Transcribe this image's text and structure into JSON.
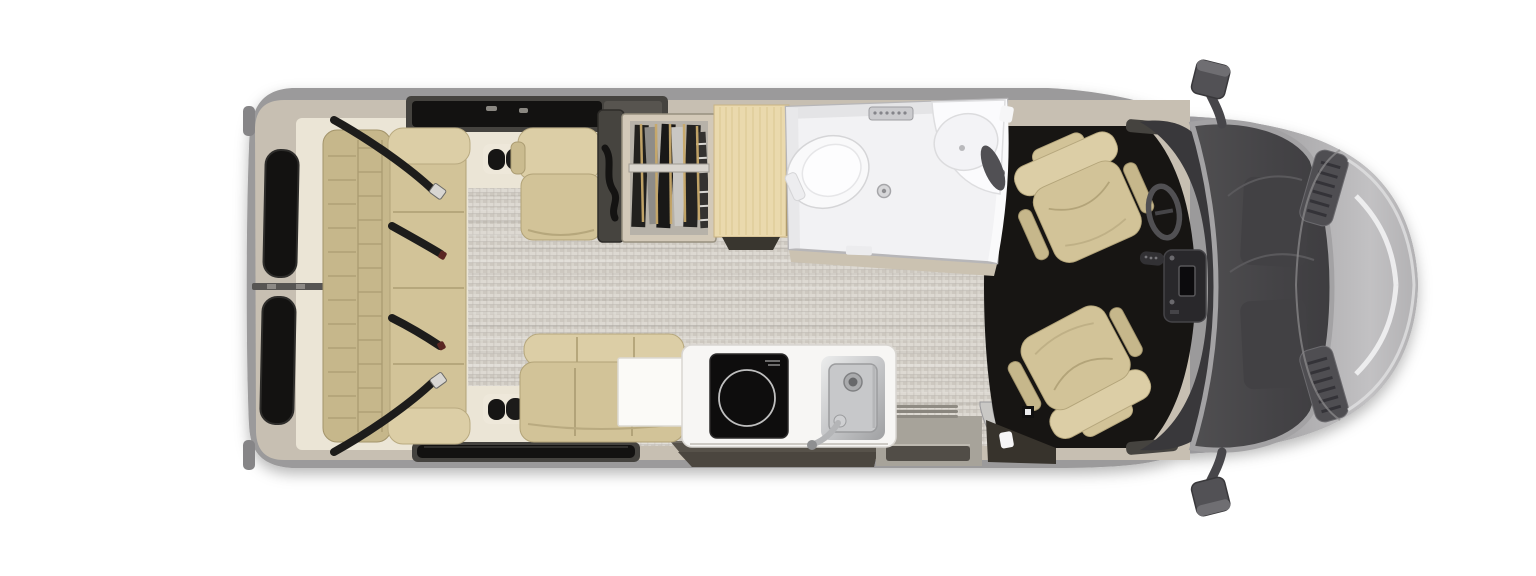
{
  "meta": {
    "title": "Class B touring coach floor plan — overhead view",
    "description": "Top-down rendering of a camper van interior: rear sofa with four seat belts, single lounge seat, wardrobe with hanging clothes, wood countertop, wet bath with toilet and corner sink, dinette bench with table, galley with induction cooktop and stainless sink, sliding-door step well, two swiveled cab chairs, dashboard with steering wheel, windshield, hood and side mirrors."
  },
  "colors": {
    "page-bg": "#ffffff",
    "body": "#9b9a9b",
    "lining": "#c7bfb2",
    "cream": "#ebe5d6",
    "floor": "#d6d2ca",
    "tan": "#d2c398",
    "tan-dark": "#b2a378",
    "tan-light": "#dccea6",
    "tan-back": "#c6b78b",
    "belt": "#1d1c1b",
    "cab": "#171513",
    "dash": "#39383b",
    "glass": "#49484a",
    "pillar": "#a3a2a4",
    "white-room": "#f2f2f4",
    "wood": "#ead9ad",
    "wood-line": "#d7c290",
    "window": "#131211",
    "trim-dark": "#45433f",
    "well": "#57524a",
    "step": "#a7a39a",
    "steel-light": "#e9eaeb",
    "steel-dark": "#a9aaac"
  },
  "floorplan": {
    "zones": [
      {
        "name": "rear",
        "items": [
          "rear-door-windows",
          "rear-sofa",
          "sofa-seat-belts"
        ]
      },
      {
        "name": "midship",
        "items": [
          "driver-side-window",
          "single-seat",
          "wardrobe",
          "wood-countertop",
          "wet-bath",
          "toilet",
          "corner-sink",
          "shower-drain"
        ]
      },
      {
        "name": "galley",
        "items": [
          "dinette-bench",
          "table",
          "induction-cooktop",
          "kitchen-sink",
          "faucet"
        ]
      },
      {
        "name": "entry",
        "items": [
          "sliding-door-step-well",
          "entry-step",
          "curbside-window"
        ]
      },
      {
        "name": "cab",
        "items": [
          "driver-swivel-chair",
          "passenger-swivel-chair",
          "steering-wheel",
          "center-console",
          "dashboard"
        ]
      },
      {
        "name": "front",
        "items": [
          "windshield",
          "hood",
          "cowl-vents",
          "left-mirror",
          "right-mirror"
        ]
      }
    ]
  }
}
